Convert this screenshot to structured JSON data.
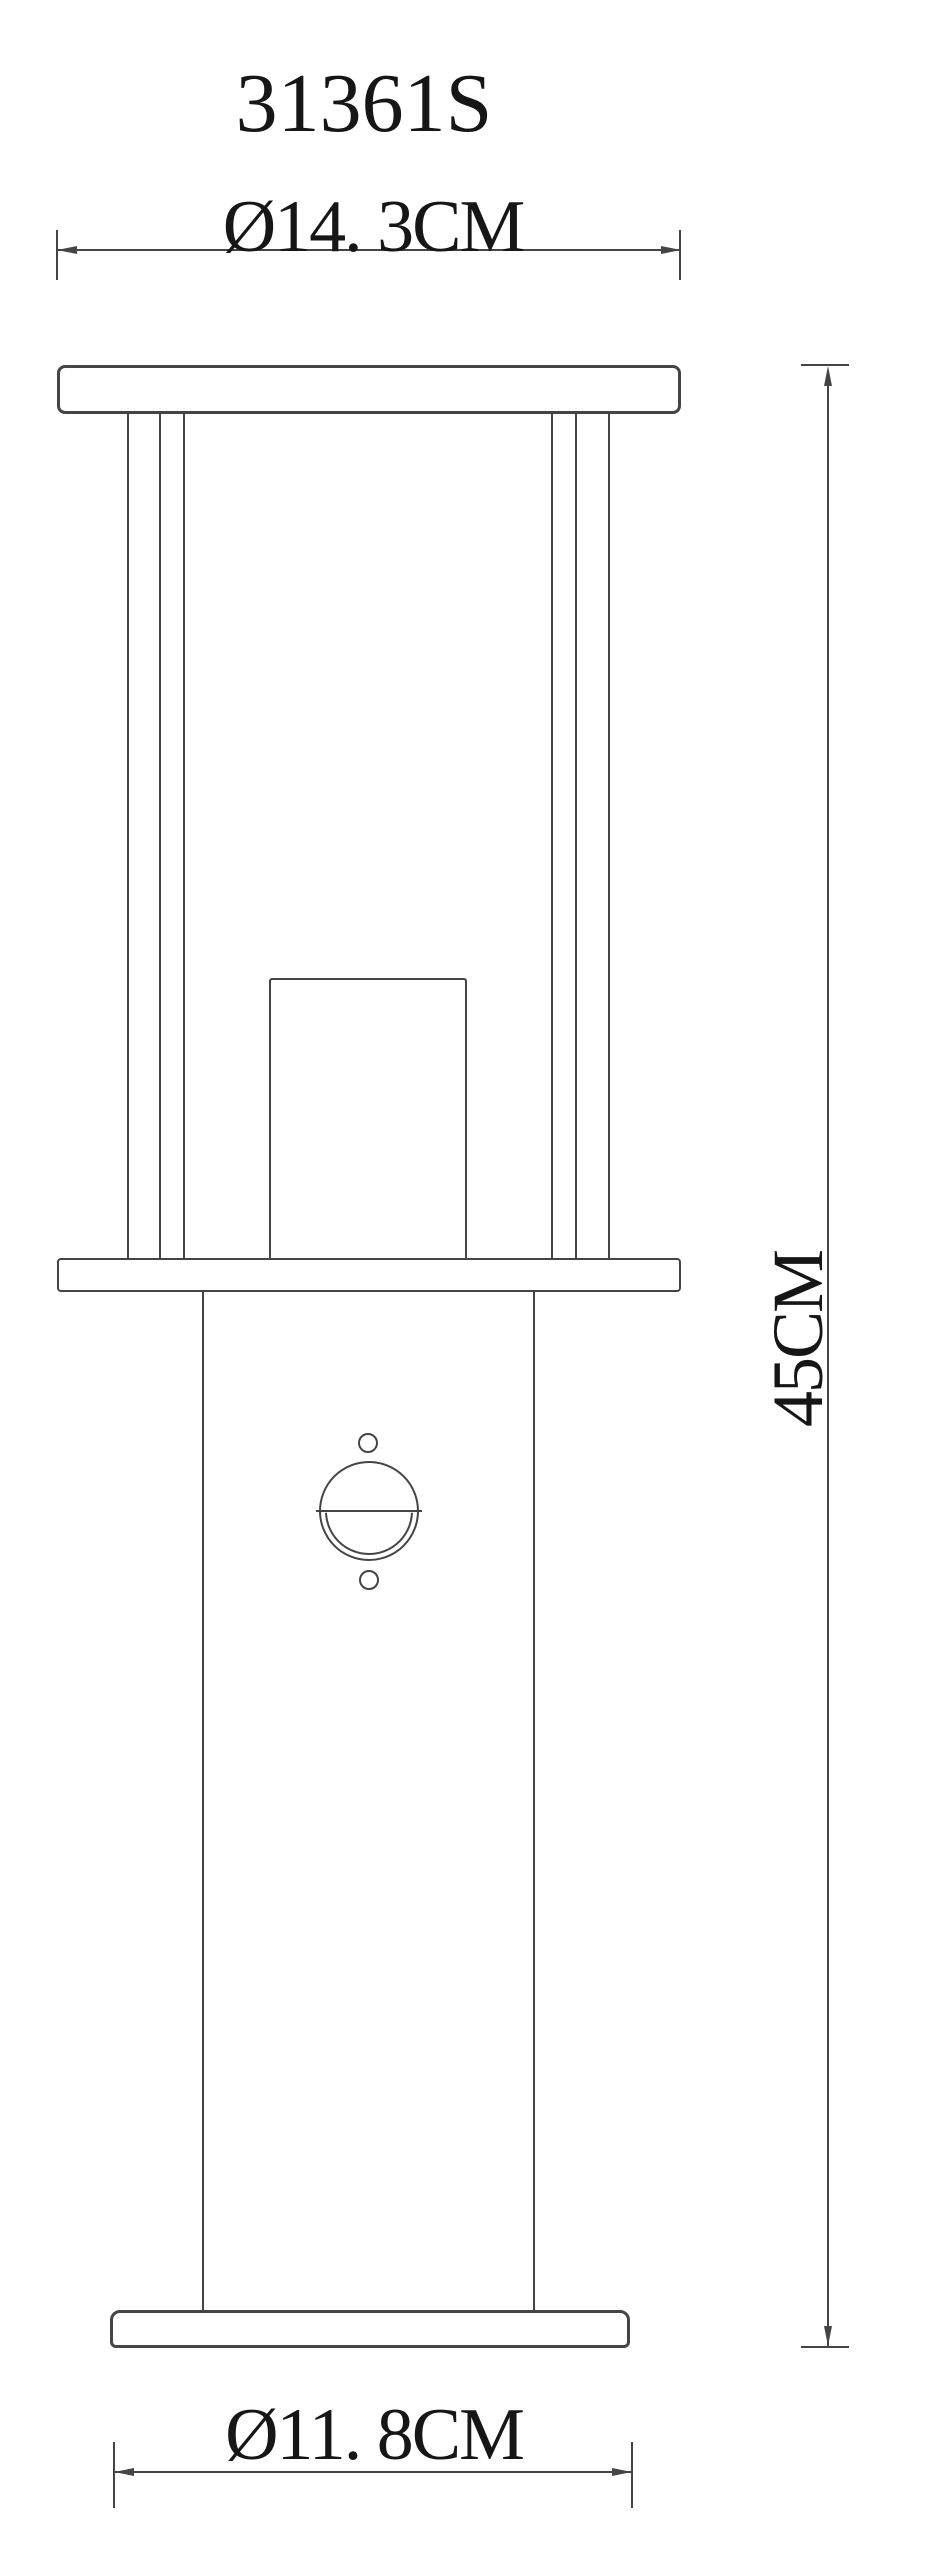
{
  "drawing": {
    "model_number": "31361S",
    "dimensions": {
      "top_diameter_label": "Ø14. 3CM",
      "height_label": "45CM",
      "base_diameter_label": "Ø11. 8CM"
    },
    "specs": {
      "top_diameter_cm": 14.3,
      "height_cm": 45,
      "base_diameter_cm": 11.8
    },
    "colors": {
      "line": "#454545",
      "text": "#161616",
      "background": "#ffffff"
    }
  }
}
